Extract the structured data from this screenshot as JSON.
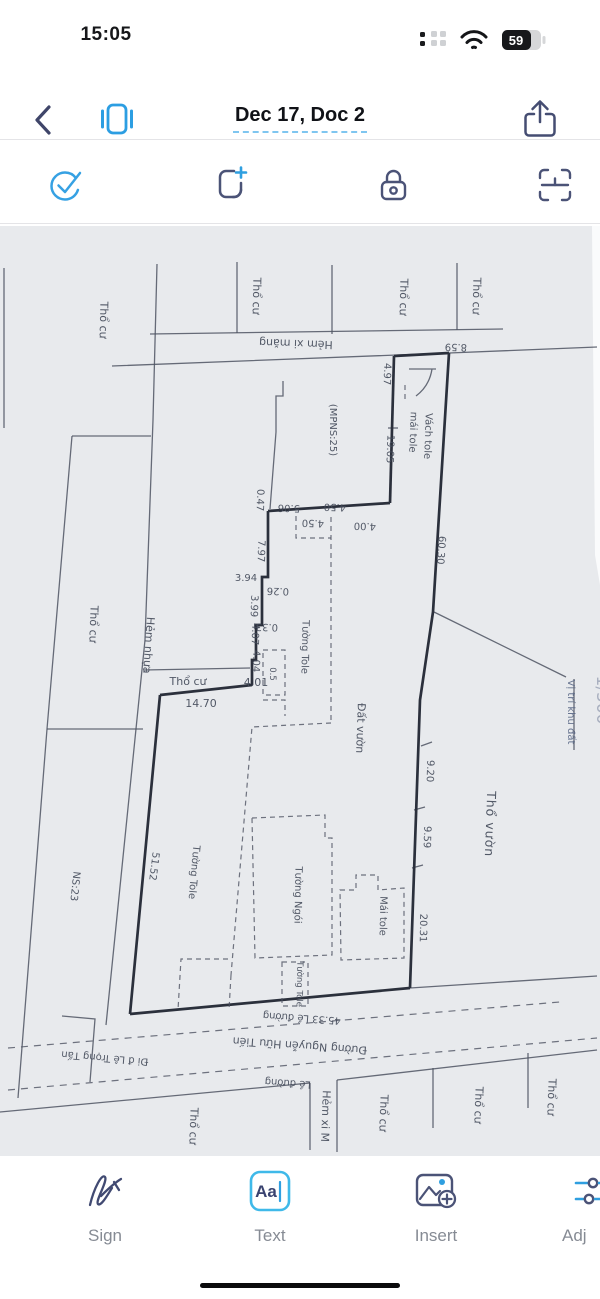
{
  "status_bar": {
    "time": "15:05",
    "battery_percent": "59"
  },
  "nav": {
    "title": "Dec 17, Doc 2"
  },
  "icons": {
    "nav": [
      "back-chevron-icon",
      "pages-icon",
      "share-icon"
    ],
    "toolbar": [
      "check-circle-icon",
      "add-page-icon",
      "lock-icon",
      "ocr-frame-icon"
    ],
    "bottom": [
      "signature-icon",
      "text-box-icon",
      "insert-image-icon",
      "adjust-sliders-icon"
    ],
    "status": [
      "cellular-icon",
      "wifi-icon",
      "battery-icon"
    ]
  },
  "text_icon_glyph": "Aa",
  "doc": {
    "labels": [
      {
        "t": "Thổ cư"
      },
      {
        "t": "Thổ cư"
      },
      {
        "t": "Thổ cư"
      },
      {
        "t": "Thổ cư"
      },
      {
        "t": "Hẻm xi măng"
      },
      {
        "t": "8.59"
      },
      {
        "t": "4.97"
      },
      {
        "t": "Vách tole"
      },
      {
        "t": "mái tole"
      },
      {
        "t": "19.05"
      },
      {
        "t": "(MPNS:25)"
      },
      {
        "t": "60.30"
      },
      {
        "t": "0.47"
      },
      {
        "t": "5.06"
      },
      {
        "t": "4.50"
      },
      {
        "t": "4.50"
      },
      {
        "t": "4.00"
      },
      {
        "t": "7.97"
      },
      {
        "t": "3.94"
      },
      {
        "t": "0.26"
      },
      {
        "t": "3.99"
      },
      {
        "t": "0.33"
      },
      {
        "t": "4.07"
      },
      {
        "t": "4.04"
      },
      {
        "t": "0.5"
      },
      {
        "t": "Thổ cư"
      },
      {
        "t": "4.01"
      },
      {
        "t": "14.70"
      },
      {
        "t": "Tường Tole"
      },
      {
        "t": "Đất vườn"
      },
      {
        "t": "Thổ cư"
      },
      {
        "t": "Hẻm nhựa"
      },
      {
        "t": "NS:23"
      },
      {
        "t": "51.52"
      },
      {
        "t": "Tường Tole"
      },
      {
        "t": "Tường Ngói"
      },
      {
        "t": "Mái tole"
      },
      {
        "t": "9.20"
      },
      {
        "t": "9.59"
      },
      {
        "t": "20.31"
      },
      {
        "t": "Thổ vườn"
      },
      {
        "t": "Vị trí khu đất"
      },
      {
        "t": "45.33 Lề đường"
      },
      {
        "t": "Đường Nguyễn Hữu Tiến"
      },
      {
        "t": "Đi đ Lê Trọng Tấn"
      },
      {
        "t": "Lề đường"
      },
      {
        "t": "Hẻm xi M"
      },
      {
        "t": "Thổ cư"
      },
      {
        "t": "Thổ cư"
      },
      {
        "t": "Thổ cư"
      },
      {
        "t": "Thổ cư"
      },
      {
        "t": "Tường Tole"
      },
      {
        "t": "1/500"
      }
    ]
  },
  "bottom": {
    "items": [
      "Sign",
      "Text",
      "Insert",
      "Adj"
    ]
  }
}
